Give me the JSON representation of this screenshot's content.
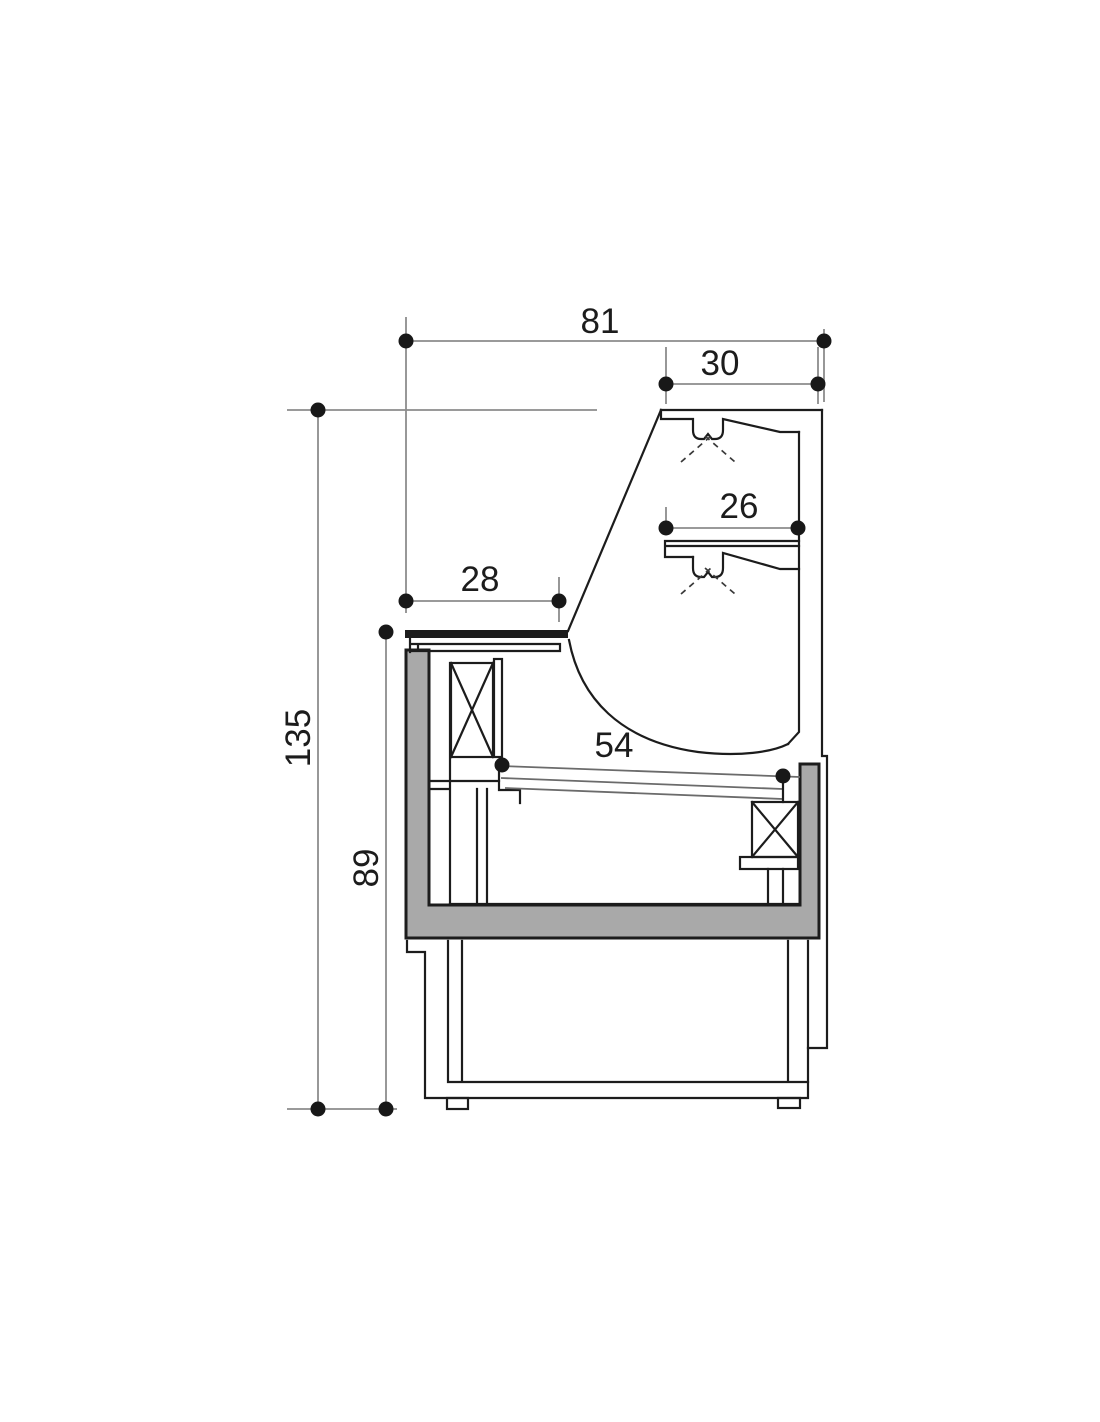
{
  "page": {
    "background": "#ffffff",
    "content": "technical-cross-section-drawing"
  },
  "drawing": {
    "subject": "serve-over-display-counter-side-section",
    "labels": {
      "overall_depth": "81",
      "top_shelf_depth": "30",
      "middle_shelf_depth": "26",
      "worktop_depth": "28",
      "display_deck_depth": "54",
      "overall_height": "135",
      "worktop_height": "89"
    },
    "colors": {
      "object_line": "#1c1c1c",
      "dimension_line": "#8c8c8c",
      "insulation_fill": "#a9a9a9",
      "background": "#ffffff"
    }
  }
}
